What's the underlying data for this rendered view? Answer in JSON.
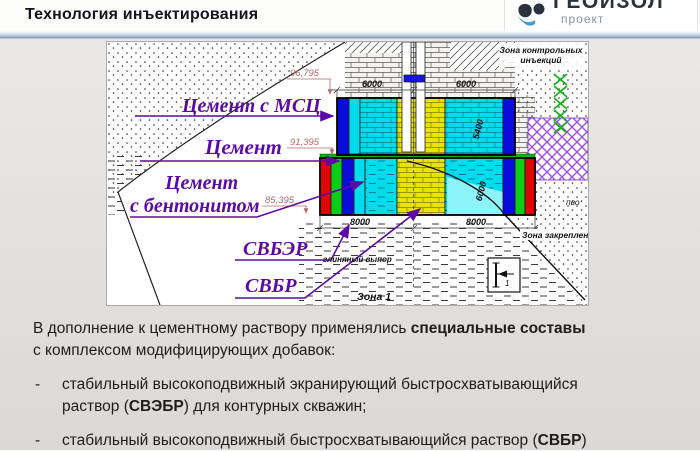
{
  "header": {
    "title": "Технология инъектирования",
    "logo": {
      "name": "ГЕОИЗОЛ",
      "sub": "проект"
    }
  },
  "diagram": {
    "labels": {
      "cement_mcc": "Цемент с МСЦ",
      "cement": "Цемент",
      "cement_bentonite_1": "Цемент",
      "cement_bentonite_2": "с бентонитом",
      "svber": "СВБЭР",
      "svbr": "СВБР"
    },
    "elevations": {
      "top": "96,795",
      "mid": "91,395",
      "low": "85,395"
    },
    "dimensions": {
      "top_left": "6000",
      "top_right": "6000",
      "bottom_left": "8000",
      "bottom_right": "8000",
      "side_upper": "5400",
      "side_lower": "6000"
    },
    "zones": {
      "control_line1": "Зона контрольных",
      "control_line2": "инъекций",
      "anchoring": "Зона закреплени",
      "zone1": "Зона 1",
      "clay": "глиняный выпор",
      "pvo": "пво",
      "marker": "1"
    },
    "colors": {
      "label_purple": "#5C0AA6",
      "elevation_red": "#B06A6A",
      "cyan": "#00DCEC",
      "yellow": "#E8E400",
      "blue": "#0B0BDB",
      "green": "#0CCC18",
      "red": "#E00505",
      "purple_hatch": "#A04FE0",
      "zigzag_green": "#17B317"
    }
  },
  "body": {
    "bullet_marker": "-",
    "intro": [
      [
        {
          "t": "В дополнение к цементному раствору применялись "
        },
        {
          "t": "специальные составы",
          "b": true
        }
      ],
      [
        {
          "t": "с комплексом модифицирующих добавок:"
        }
      ]
    ],
    "bullets": [
      [
        [
          {
            "t": "стабильный высокоподвижный экранирующий быстросхватывающийся"
          }
        ],
        [
          {
            "t": "раствор ("
          },
          {
            "t": "СВЭБР",
            "b": true
          },
          {
            "t": ") для контурных скважин;"
          }
        ]
      ],
      [
        [
          {
            "t": "стабильный высокоподвижный быстросхватывающийся раствор ("
          },
          {
            "t": "СВБР",
            "b": true
          },
          {
            "t": ")"
          }
        ]
      ]
    ]
  }
}
